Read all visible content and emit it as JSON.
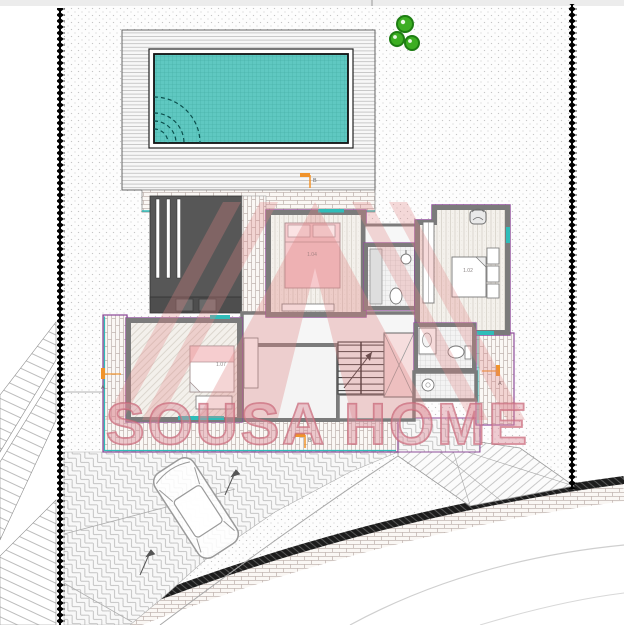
{
  "drawing": {
    "type": "architectural-site-plan",
    "watermark": {
      "text": "SOUSA HOME",
      "logo": "triangle-A-logo"
    },
    "rooms": [
      {
        "label": "1.04"
      },
      {
        "label": "1.02"
      },
      {
        "label": "1.07"
      }
    ],
    "section_markers": [
      {
        "letter": "B"
      },
      {
        "letter": "B"
      },
      {
        "letter": "A"
      },
      {
        "letter": "A"
      }
    ],
    "colors": {
      "pool_water": "#5fc8c1",
      "window_teal": "#2fbdb9",
      "wall_outline_purple": "#8e4d9a",
      "watermark_pink": "#e08585",
      "marker_orange": "#f0932b",
      "bush_green": "#3cae22",
      "structure_dark_gray": "#575757",
      "boundary_black": "#000000"
    }
  }
}
